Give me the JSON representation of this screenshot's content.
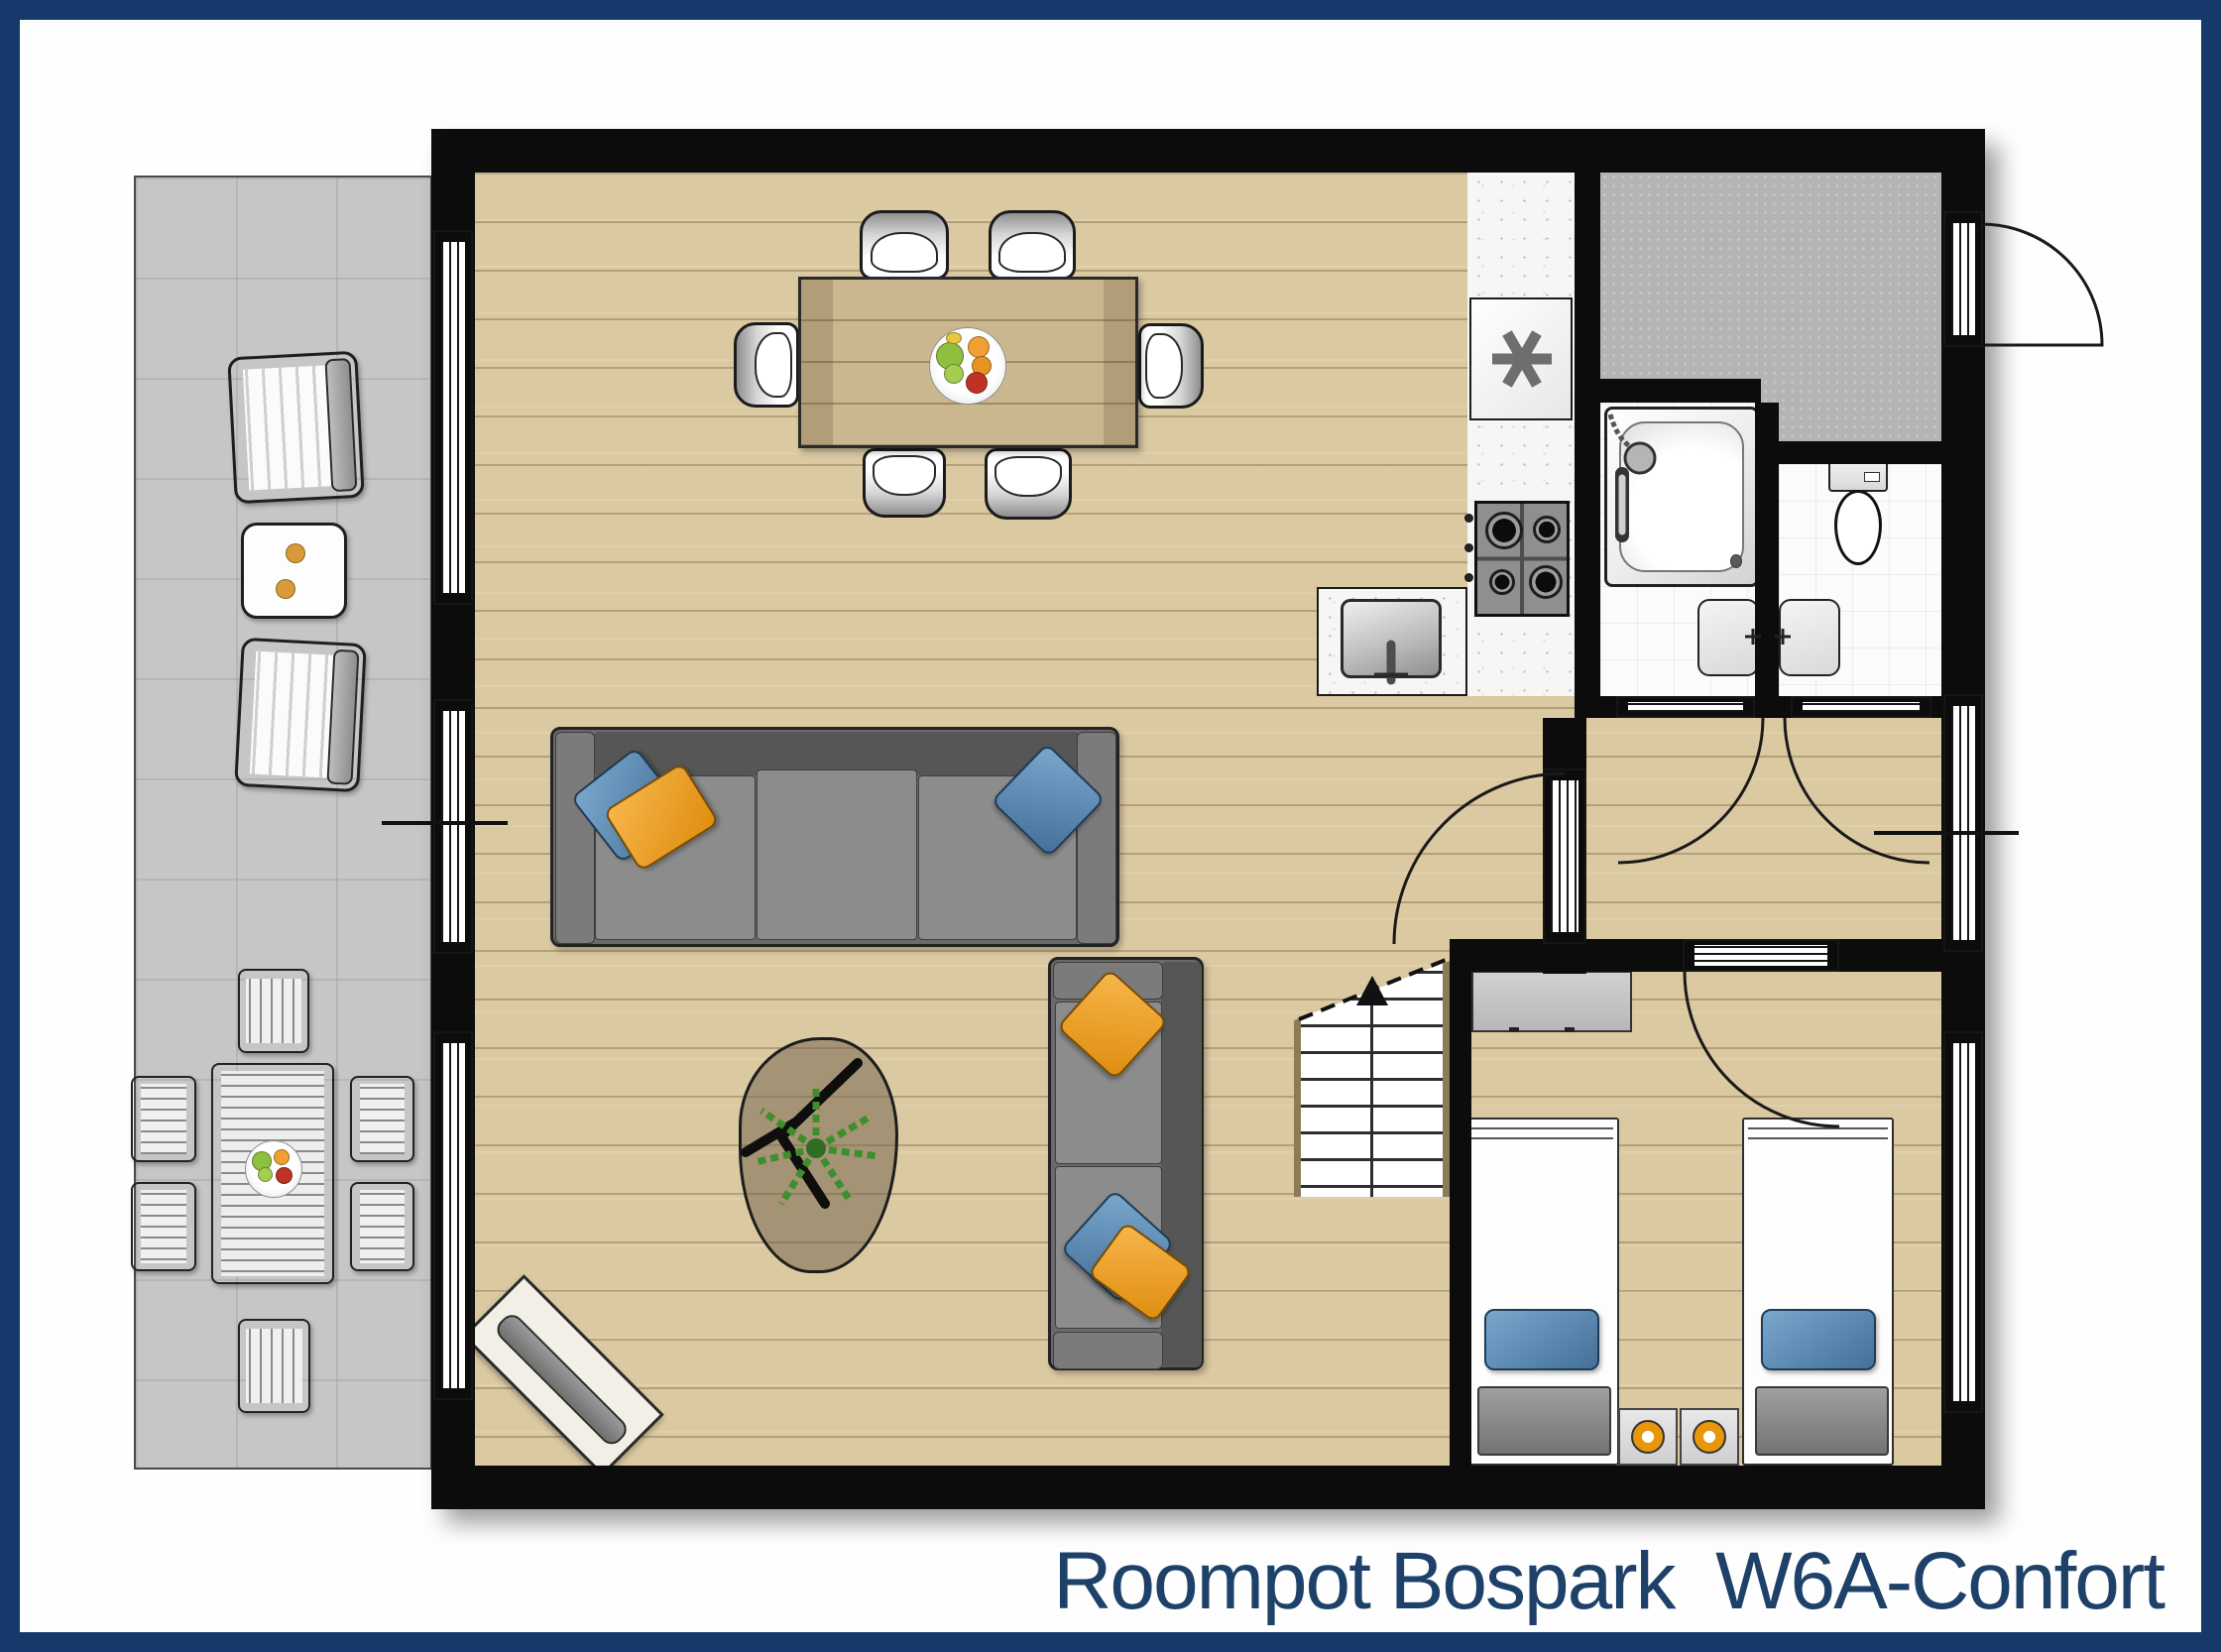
{
  "caption": {
    "text": "Roompot Bospark  W6A-Confort"
  },
  "palette": {
    "frame_navy": "#16396b",
    "caption_navy": "#1d4168",
    "wall_black": "#0c0c0c",
    "wood_floor": "#dbc9a1",
    "table_wood": "#cbb78f",
    "terrace_gray": "#c6c6c6",
    "hall_gray": "#b4b4b2",
    "bath_tile_white": "#fbfbfb",
    "sofa_gray": "#6a6a6a",
    "cushion_blue": "#5b93c4",
    "cushion_orange": "#efa226",
    "plant_green": "#3e8f2c",
    "lamp_orange": "#e8960c"
  },
  "plan": {
    "dwelling_type_label": "W6A-Confort",
    "park_label": "Roompot Bospark"
  }
}
